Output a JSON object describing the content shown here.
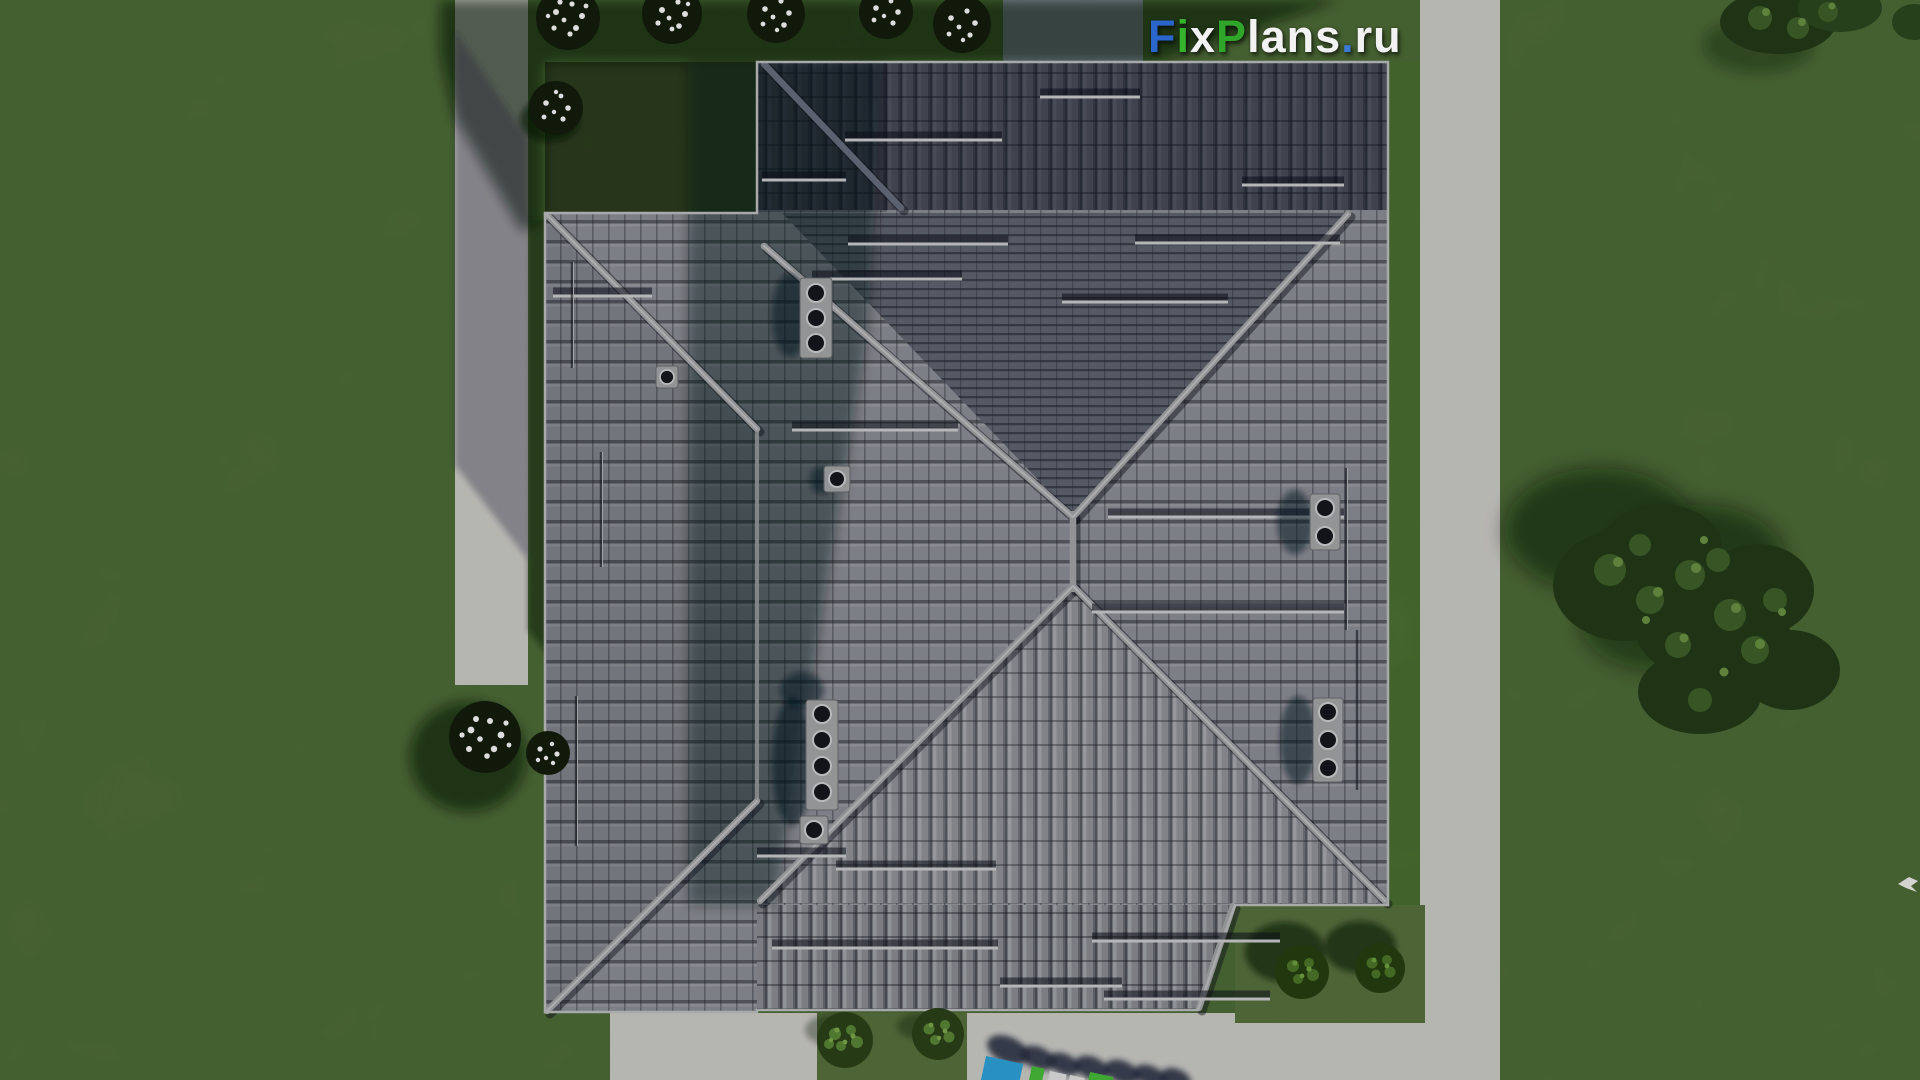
{
  "logo": {
    "text": "FixPlans.ru",
    "parts": [
      {
        "t": "F",
        "c": "#2b66cc"
      },
      {
        "t": "i",
        "c": "#35b32c"
      },
      {
        "t": "x",
        "c": "#f2f2f2"
      },
      {
        "t": "P",
        "c": "#2fa52a"
      },
      {
        "t": "lans",
        "c": "#f2f2f2"
      },
      {
        "t": ".",
        "c": "#3a7bd5"
      },
      {
        "t": "ru",
        "c": "#f2f2f2"
      }
    ]
  },
  "watermark": {
    "text": "FixPlans.ru",
    "letter_colors": [
      "#2fa8e0",
      "#49c23a",
      "#e8e8e8",
      "#49c23a",
      "#e8e8e8"
    ]
  },
  "palette": {
    "grass": "#59743f",
    "grass_bright": "#567a38",
    "grass_shadow": "#15200e",
    "path": "#d3d2cd",
    "path_shadowed": "#8f94a6",
    "roof_light": "#90939b",
    "roof_dark": "#3c4150",
    "ridge": "#a8aaac",
    "foliage": "#3c5a28",
    "flowers": "#ffffff"
  }
}
